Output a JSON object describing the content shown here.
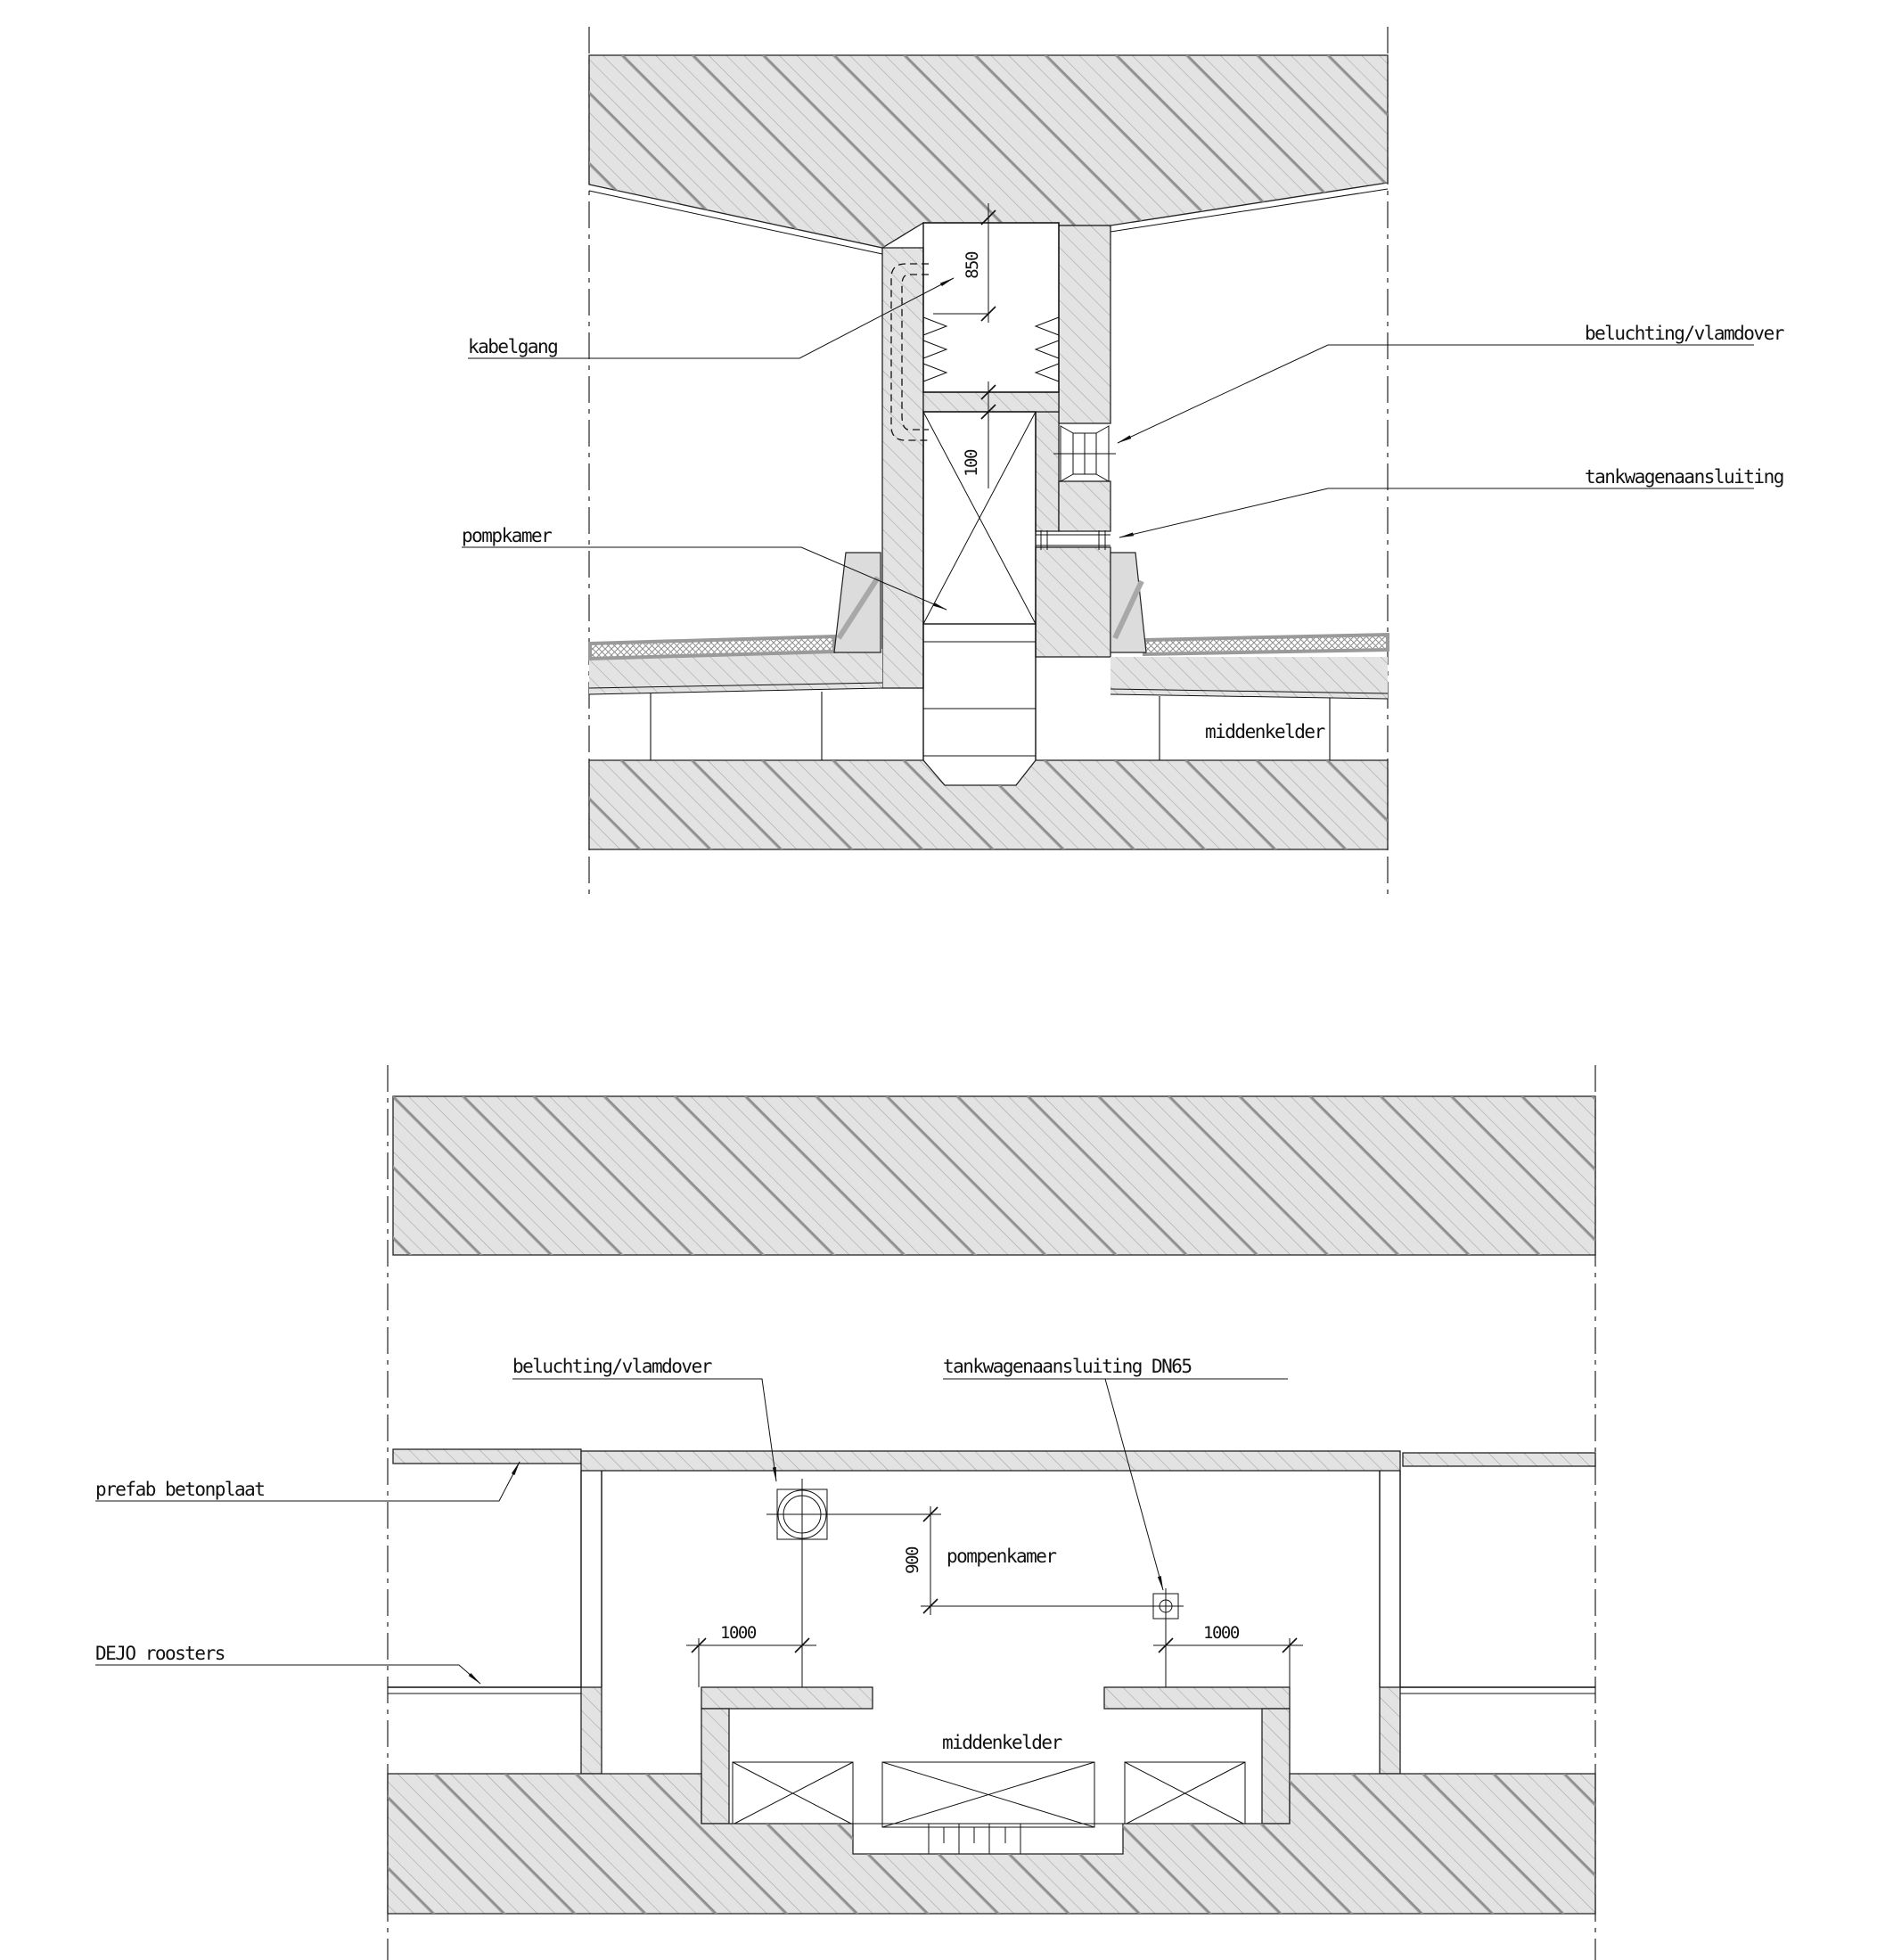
{
  "drawing": {
    "type": "technical-section-and-plan",
    "line_color": "#1a1a1a",
    "hatch_fill": "#e3e3e3",
    "curb_fill": "#dcdcdc"
  },
  "top_section": {
    "labels": {
      "kabelgang": "kabelgang",
      "pompkamer": "pompkamer",
      "beluchting": "beluchting/vlamdover",
      "tankwagen": "tankwagenaansluiting",
      "middenkelder": "middenkelder"
    },
    "dims": {
      "d850": "850",
      "d100": "100"
    }
  },
  "bottom_plan": {
    "labels": {
      "beluchting": "beluchting/vlamdover",
      "tankwagen_dn65": "tankwagenaansluiting DN65",
      "prefab": "prefab betonplaat",
      "dejo": "DEJO roosters",
      "pompenkamer": "pompenkamer",
      "middenkelder": "middenkelder"
    },
    "dims": {
      "d900": "900",
      "d1000_left": "1000",
      "d1000_right": "1000"
    }
  }
}
